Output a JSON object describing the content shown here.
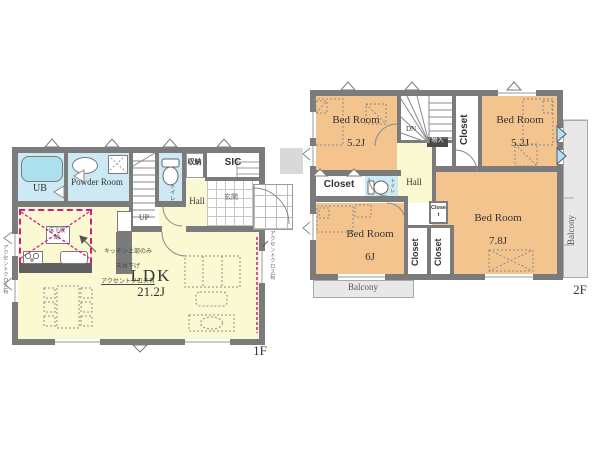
{
  "colors": {
    "wall": "#7b7b7b",
    "room_yellow": "#FAF9D1",
    "room_blue": "#CDE9F3",
    "room_orange": "#F4C48F",
    "balcony_gray": "#E8E8E8",
    "fixture_blue": "#ADE0EF",
    "accent_magenta": "#D6198A"
  },
  "floor1": {
    "label": "1F",
    "rooms": {
      "ub": "UB",
      "powder": "Powder Room",
      "toilet": "トイレ",
      "storage": "収納",
      "sic": "SIC",
      "genkan": "玄関",
      "hall": "Hall",
      "up": "UP",
      "ldk": "LDK",
      "ldk_size": "21.2J",
      "floor_storage": "床下収納"
    },
    "notes": {
      "kitchen_l1": "キッチン上部のみ",
      "kitchen_l2": "天井下げ",
      "kitchen_l3": "アクセントクロス有",
      "left_wall": "アクセントクロス有",
      "right_wall": "アクセントクロス有"
    }
  },
  "floor2": {
    "label": "2F",
    "rooms": {
      "bedroom_nw": "Bed Room",
      "bedroom_nw_size": "5.2J",
      "bedroom_ne": "Bed Room",
      "bedroom_ne_size": "5.2J",
      "bedroom_sw": "Bed Room",
      "bedroom_sw_size": "6J",
      "bedroom_se": "Bed Room",
      "bedroom_se_size": "7.8J",
      "hall": "Hall",
      "dn": "DN",
      "toilet": "トイレ",
      "under_stairs": "物入",
      "closet_nw": "Closet",
      "closet_w": "Closet",
      "closet_small": "Closet",
      "closet_mid1": "Closet",
      "closet_mid2": "Closet",
      "balcony_right": "Balcony",
      "balcony_bottom": "Balcony"
    }
  }
}
